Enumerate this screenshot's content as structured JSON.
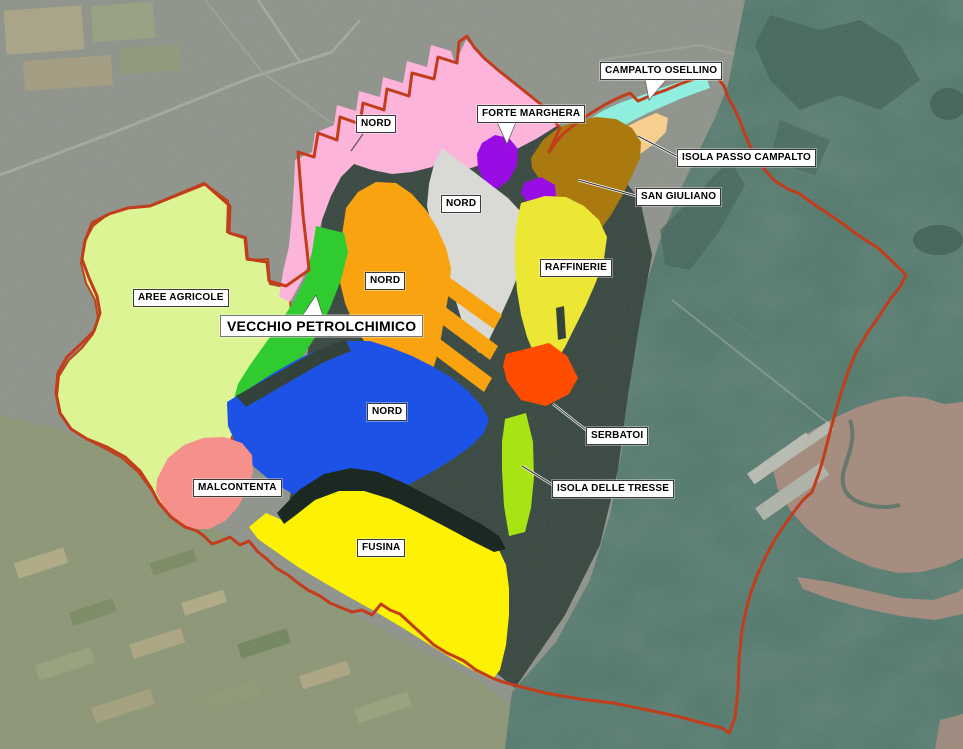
{
  "labels": [
    {
      "id": "campalto-osellino",
      "text": "CAMPALTO OSELLINO"
    },
    {
      "id": "forte-marghera",
      "text": "FORTE MARGHERA"
    },
    {
      "id": "isola-passo-campalto",
      "text": "ISOLA PASSO CAMPALTO"
    },
    {
      "id": "san-giuliano",
      "text": "SAN GIULIANO"
    },
    {
      "id": "nord-pink",
      "text": "NORD"
    },
    {
      "id": "nord-gray",
      "text": "NORD"
    },
    {
      "id": "nord-orange",
      "text": "NORD"
    },
    {
      "id": "raffinerie",
      "text": "RAFFINERIE"
    },
    {
      "id": "aree-agricole",
      "text": "AREE AGRICOLE"
    },
    {
      "id": "vecchio-petrolchimico",
      "text": "VECCHIO PETROLCHIMICO"
    },
    {
      "id": "nord-blue",
      "text": "NORD"
    },
    {
      "id": "serbatoi",
      "text": "SERBATOI"
    },
    {
      "id": "isola-delle-tresse",
      "text": "ISOLA DELLE TRESSE"
    },
    {
      "id": "malcontenta",
      "text": "MALCONTENTA"
    },
    {
      "id": "fusina",
      "text": "FUSINA"
    }
  ],
  "zones": {
    "nord_pink": {
      "label": "NORD",
      "color": "#fcb4da"
    },
    "campalto_osellino": {
      "label": "CAMPALTO OSELLINO",
      "color": "#8feede"
    },
    "isola_passo_campalto": {
      "label": "ISOLA PASSO CAMPALTO",
      "color": "#f6cf8f"
    },
    "san_giuliano": {
      "label": "SAN GIULIANO",
      "color": "#aa7a10"
    },
    "forte_marghera": {
      "label": "FORTE MARGHERA",
      "color": "#9a0ce4"
    },
    "nord_gray": {
      "label": "NORD",
      "color": "#d9d9d5"
    },
    "nord_orange": {
      "label": "NORD",
      "color": "#f8a30f"
    },
    "vecchio_petrolchimico": {
      "label": "VECCHIO PETROLCHIMICO",
      "color": "#2fcb2f"
    },
    "raffinerie": {
      "label": "RAFFINERIE",
      "color": "#ece635"
    },
    "aree_agricole": {
      "label": "AREE AGRICOLE",
      "color": "#dcf493",
      "outline": "#b5451f"
    },
    "nord_blue": {
      "label": "NORD",
      "color": "#1d52e6"
    },
    "serbatoi": {
      "label": "SERBATOI",
      "color": "#fe4c01"
    },
    "isola_delle_tresse": {
      "label": "ISOLA DELLE TRESSE",
      "color": "#a8e414"
    },
    "malcontenta": {
      "label": "MALCONTENTA",
      "color": "#f5908a"
    },
    "fusina": {
      "label": "FUSINA",
      "color": "#fdf203"
    }
  },
  "boundary": {
    "color": "#c23d1c"
  },
  "background": {
    "urban": "#8d9289",
    "fields": "#8b9574",
    "water": "#4d7568",
    "marsh": "#3f6156",
    "port_water": "#33433b",
    "dock": "#1c2922",
    "venice": "#a3897b",
    "road": "#b9bdb3"
  }
}
